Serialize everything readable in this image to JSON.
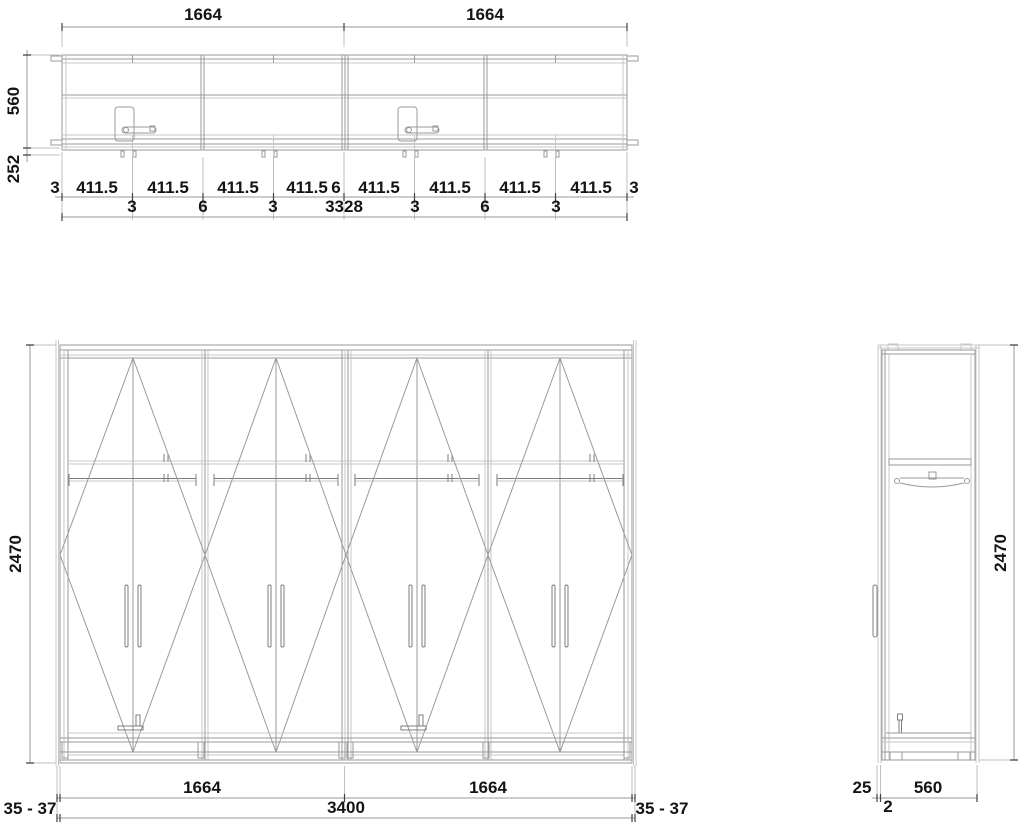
{
  "drawing": {
    "colors": {
      "background": "#ffffff",
      "line": "#9a9a9a",
      "line_dark": "#7d7d7d",
      "line_light": "#c7c7c7",
      "text": "#141414"
    },
    "top_view": {
      "width_left": "1664",
      "width_right": "1664",
      "depth": "560",
      "front_ext": "252",
      "chain_upper": [
        "3",
        "411.5",
        "411.5",
        "411.5",
        "411.5",
        "6",
        "411.5",
        "411.5",
        "411.5",
        "411.5",
        "3"
      ],
      "chain_lower": [
        "3",
        "6",
        "3",
        "3",
        "6",
        "3"
      ],
      "total": "3328"
    },
    "front_view": {
      "height": "2470",
      "unit_width_left": "1664",
      "unit_width_right": "1664",
      "total_width": "3400",
      "wall_gap_left": "35 - 37",
      "wall_gap_right": "35 - 37"
    },
    "side_view": {
      "height": "2470",
      "front_offset": "25",
      "gap": "2",
      "depth": "560"
    }
  }
}
